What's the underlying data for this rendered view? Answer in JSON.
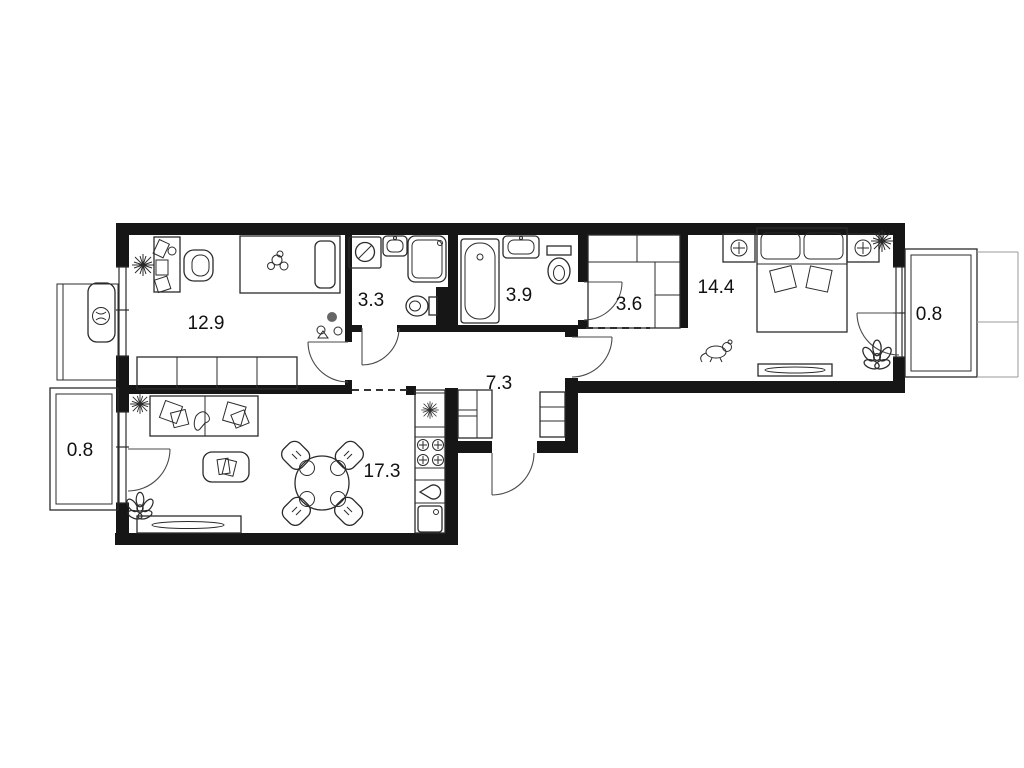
{
  "plan": {
    "type": "apartment-floor-plan",
    "background": "#ffffff",
    "wall_color": "#161616",
    "rooms": [
      {
        "name": "bedroom-left",
        "area_label": "12.9"
      },
      {
        "name": "bathroom-small",
        "area_label": "3.3"
      },
      {
        "name": "bathroom-large",
        "area_label": "3.9"
      },
      {
        "name": "walk-in-closet",
        "area_label": "3.6"
      },
      {
        "name": "bedroom-right",
        "area_label": "14.4"
      },
      {
        "name": "balcony-right",
        "area_label": "0.8"
      },
      {
        "name": "hallway",
        "area_label": "7.3"
      },
      {
        "name": "kitchen-living-room",
        "area_label": "17.3"
      },
      {
        "name": "balcony-left",
        "area_label": "0.8"
      }
    ]
  }
}
